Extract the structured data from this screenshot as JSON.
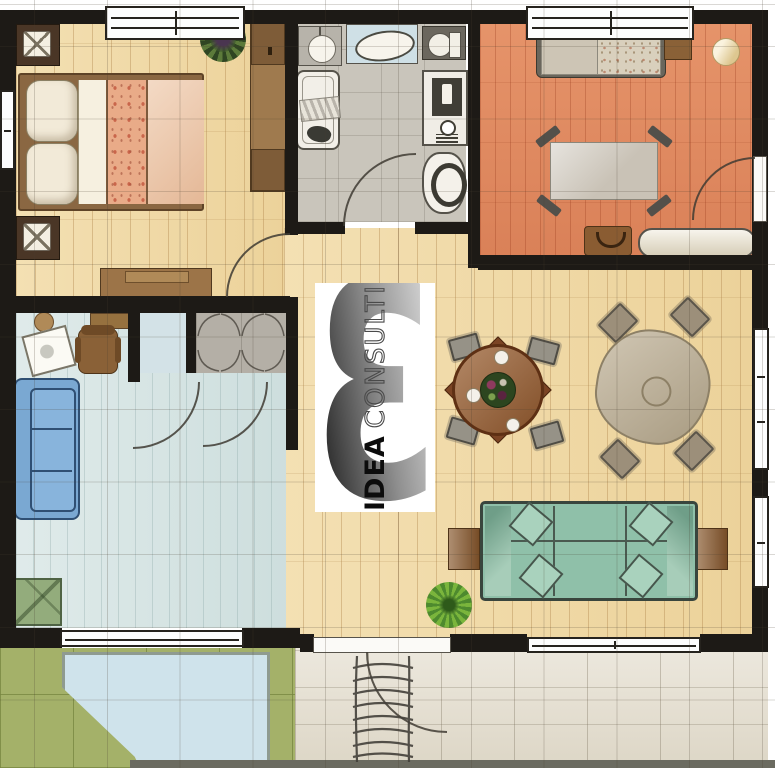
{
  "watermark": {
    "number": "3",
    "brand_bold": "IDEA",
    "brand_light": "CONSULTING"
  },
  "colors": {
    "wall": "#1d1a16",
    "wood_floor": "#f1d9a2",
    "terracotta_floor": "#e0885e",
    "office_floor": "#d5e4e3",
    "bathroom_floor": "#c9c5bb",
    "closet_floor": "#b4afa6",
    "lawn": "#a4b169",
    "pool_patio": "#cfe3eb",
    "terrace": "#e6e0d2",
    "sofa_teal": "#8fc0a9",
    "couch_blue": "#7aa8d2",
    "armchair_green": "#93ac7c",
    "bed_blanket_peach": "#edc6a6",
    "furniture_brown": "#8a5c32",
    "plant_green": "#7ab53c"
  },
  "rooms": [
    {
      "name": "bedroom",
      "floor_color": "#f1d9a2",
      "furniture": [
        "double-bed",
        "nightstand-with-lamp",
        "nightstand-with-lamp",
        "wardrobe",
        "dresser",
        "plant"
      ]
    },
    {
      "name": "bathroom",
      "floor_color": "#c9c5bb",
      "furniture": [
        "vanity-sink",
        "shower-tray",
        "toilet",
        "bathtub",
        "washing-machine",
        "bidet"
      ]
    },
    {
      "name": "bedroom-2",
      "floor_color": "#e0885e",
      "furniture": [
        "single-bed",
        "side-table",
        "pouf",
        "table-with-splayed-legs",
        "bag",
        "bench"
      ]
    },
    {
      "name": "office",
      "floor_color": "#d5e4e3",
      "furniture": [
        "desk",
        "office-chair",
        "drawing-board",
        "stool",
        "blue-sofa",
        "green-armchair",
        "closet",
        "folding-door-closet"
      ]
    },
    {
      "name": "living-dining",
      "floor_color": "#f1d9a2",
      "furniture": [
        "round-dining-table-with-plates",
        "clothed-dining-table",
        "dining-chairs",
        "teal-sofa",
        "side-table",
        "side-table",
        "plant"
      ]
    },
    {
      "name": "outdoor",
      "floor_color": "#a4b169",
      "furniture": [
        "pool-patio",
        "tiled-terrace",
        "stairs"
      ]
    }
  ]
}
